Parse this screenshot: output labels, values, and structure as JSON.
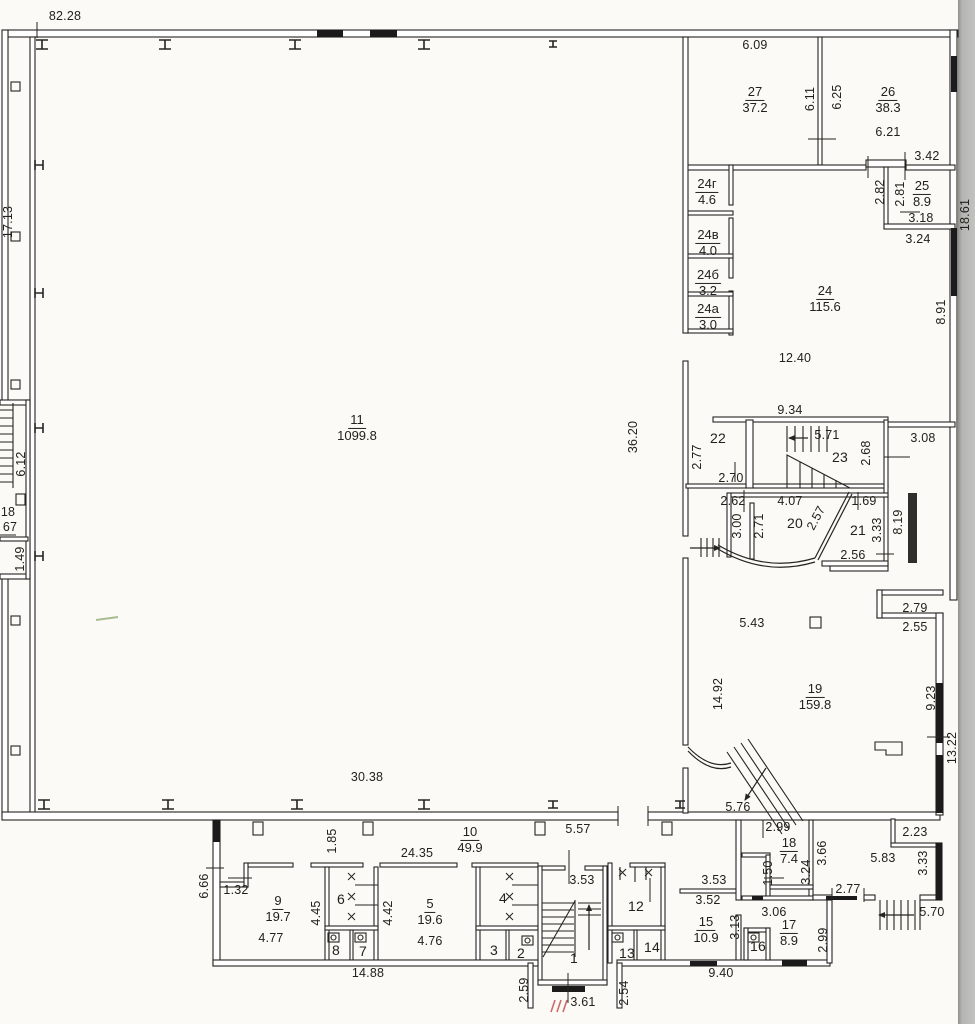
{
  "rooms": {
    "r1": {
      "num": "1"
    },
    "r2": {
      "num": "2"
    },
    "r3": {
      "num": "3"
    },
    "r4": {
      "num": "4"
    },
    "r5": {
      "num": "5",
      "area": "19.6"
    },
    "r6": {
      "num": "6"
    },
    "r7": {
      "num": "7"
    },
    "r8": {
      "num": "8"
    },
    "r9": {
      "num": "9",
      "area": "19.7"
    },
    "r10": {
      "num": "10",
      "area": "49.9"
    },
    "r11": {
      "num": "11",
      "area": "1099.8"
    },
    "r12": {
      "num": "12"
    },
    "r13": {
      "num": "13"
    },
    "r14": {
      "num": "14"
    },
    "r15": {
      "num": "15",
      "area": "10.9"
    },
    "r16": {
      "num": "16"
    },
    "r17": {
      "num": "17",
      "area": "8.9"
    },
    "r18": {
      "num": "18",
      "area": "7.4"
    },
    "r19": {
      "num": "19",
      "area": "159.8"
    },
    "r20": {
      "num": "20"
    },
    "r21": {
      "num": "21"
    },
    "r22": {
      "num": "22"
    },
    "r23": {
      "num": "23"
    },
    "r24": {
      "num": "24",
      "area": "115.6"
    },
    "r24a": {
      "num": "24а",
      "area": "3.0"
    },
    "r24b": {
      "num": "24б",
      "area": "3.2"
    },
    "r24v": {
      "num": "24в",
      "area": "4.0"
    },
    "r24g": {
      "num": "24г",
      "area": "4.6"
    },
    "r25": {
      "num": "25",
      "area": "8.9"
    },
    "r26": {
      "num": "26",
      "area": "38.3"
    },
    "r27": {
      "num": "27",
      "area": "37.2"
    }
  },
  "dims": {
    "ow_top": "82.28",
    "ow_left": "17.13",
    "hall_w": "30.38",
    "hall_h": "36.20",
    "right_h": "18.61",
    "r27_w": "6.09",
    "r27_h": "6.11",
    "r26_h": "6.25",
    "r26_w": "6.21",
    "door_24": "3.42",
    "r25_h1": "2.82",
    "r25_h2": "2.81",
    "r25_w1": "3.18",
    "r25_w2": "3.24",
    "r24_w": "12.40",
    "r24_s": "9.34",
    "r24_h": "8.91",
    "r22_h": "2.77",
    "r22_w": "2.70",
    "r23_w": "5.71",
    "r23_h": "2.68",
    "d_308": "3.08",
    "r20_t1": "2.62",
    "r20_t2": "4.07",
    "r21_t": "1.69",
    "r20_h1": "3.00",
    "r20_h2": "2.71",
    "r20_d": "2.57",
    "r21_h": "3.33",
    "r21_w": "2.56",
    "shaft_h": "8.19",
    "r19_n1": "2.79",
    "r19_n2": "2.55",
    "r19_t": "5.43",
    "r19_h": "14.92",
    "r19_r1": "9.23",
    "r19_r2": "13.22",
    "r19_b": "5.76",
    "lst_h": "6.12",
    "lst_num": "18",
    "lst_area": "67",
    "lst_b": "1.49",
    "cor_w": "5.57",
    "cor_n": "1.85",
    "blk_w": "24.35",
    "bl_h": "6.66",
    "bl_n": "1.32",
    "r9_w": "4.77",
    "r9_h": "4.45",
    "r5_h": "4.42",
    "r5_w": "4.76",
    "bl_b": "14.88",
    "st1_t": "3.53",
    "st1_b": "3.61",
    "vest_l": "2.59",
    "vest_r": "2.54",
    "r15_t1": "3.52",
    "r15_t2": "3.53",
    "r15_h": "3.13",
    "bc_b": "9.40",
    "br_t": "2.99",
    "r18_h": "1.50",
    "r18_r": "3.24",
    "r18_o": "3.66",
    "porch_t": "2.23",
    "porch_w": "5.83",
    "porch_h": "3.33",
    "porch_d": "2.77",
    "steps_w": "5.70",
    "r17_t": "3.06",
    "r17_o": "2.99"
  }
}
